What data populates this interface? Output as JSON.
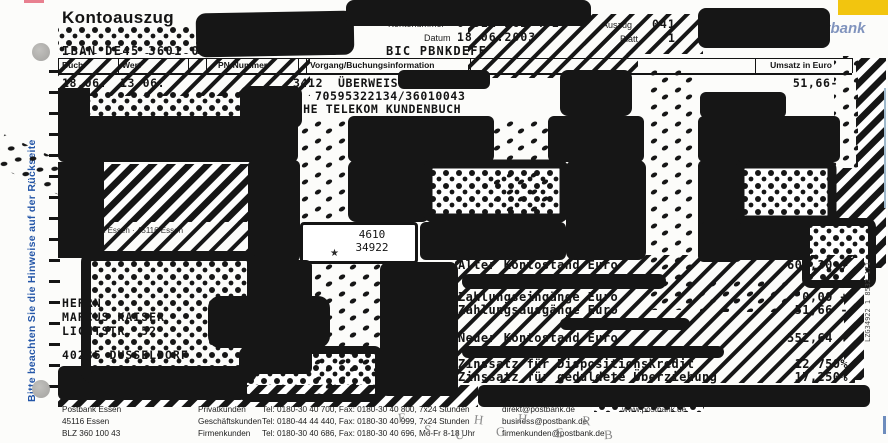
{
  "colors": {
    "marker": "#161616",
    "logo_yellow": "#f2c50f",
    "logo_blue": "#1c3e8c",
    "sidebar_blue": "#2456a8"
  },
  "header": {
    "title": "Kontoauszug",
    "iban": "IBAN DE45 3601 0043 0311 2624 32",
    "bic": "BIC PBNKDEFF",
    "kontonummer_label": "Kontonummer",
    "kontonummer": "0 311 262 432",
    "datum_label": "Datum",
    "datum": "18.06.2003",
    "auszug_label": "Auszug",
    "auszug": "041",
    "blatt_label": "Blatt",
    "blatt": "1",
    "logo": "Postbank"
  },
  "table": {
    "col_buch": "Buch.",
    "col_wert": "Wert",
    "col_pn": "PN-Nummer",
    "col_vorgang": "Vorgang/Buchungsinformation",
    "col_umsatz": "Umsatz in Euro",
    "row": {
      "buch": "18.06.",
      "wert": "13.06.",
      "pn": "3412",
      "vorgang": "ÜBERWEISUNG",
      "ref": "70595322134/36010043",
      "party": "DEUTSCHE TELEKOM KUNDENBUCH",
      "umsatz": "51,66-"
    }
  },
  "stamp": {
    "line1": "4610",
    "line2": "34922",
    "mark": "★"
  },
  "sender_line": "Postbank Essen · 45116 Essen",
  "address": [
    "HERRN",
    "MARCUS KAISER",
    "LICHTSTR. 52",
    "40235 DUSSELDORF"
  ],
  "summary": {
    "rows": [
      {
        "label": "Alter Kontostand Euro",
        "value": "604,30 +"
      },
      {
        "label": "Zahlungseingänge Euro",
        "value": "0,00 +"
      },
      {
        "label": "Zahlungsausgänge Euro",
        "value": "51,66 -"
      },
      {
        "label": "Neuer Kontostand Euro",
        "value": "552,64 +"
      },
      {
        "label": "Zinssatz für Dispositionskredit",
        "value": "12,750%"
      },
      {
        "label": "Zinssatz für geduldete Überziehung",
        "value": "17,250%"
      }
    ]
  },
  "sidebar_left": "Bitte beachten Sie die Hinweise auf der Rückseite",
  "print_code": "LZG34922 1 8532 171",
  "footer": {
    "bank": [
      "Postbank Essen",
      "45116 Essen",
      "BLZ 360 100 43"
    ],
    "rows": [
      {
        "segment": "Privatkunden",
        "contact": "Tel: 0180-30 40 700, Fax: 0180-30 40 800, 7x24 Stunden",
        "email": "direkt@postbank.de"
      },
      {
        "segment": "Geschäftskunden",
        "contact": "Tel: 0180-44 44 440, Fax: 0180-30 40 999, 7x24 Stunden",
        "email": "business@postbank.de"
      },
      {
        "segment": "Firmenkunden",
        "contact": "Tel: 0180-30 40 686, Fax: 0180-30 40 696, Mo-Fr 8-18 Uhr",
        "email": "firmenkunden@postbank.de"
      }
    ],
    "web": "www.postbank.de"
  },
  "graffiti": [
    "E",
    "S",
    "U",
    "H",
    "C",
    "H",
    "E",
    "R",
    "B"
  ]
}
